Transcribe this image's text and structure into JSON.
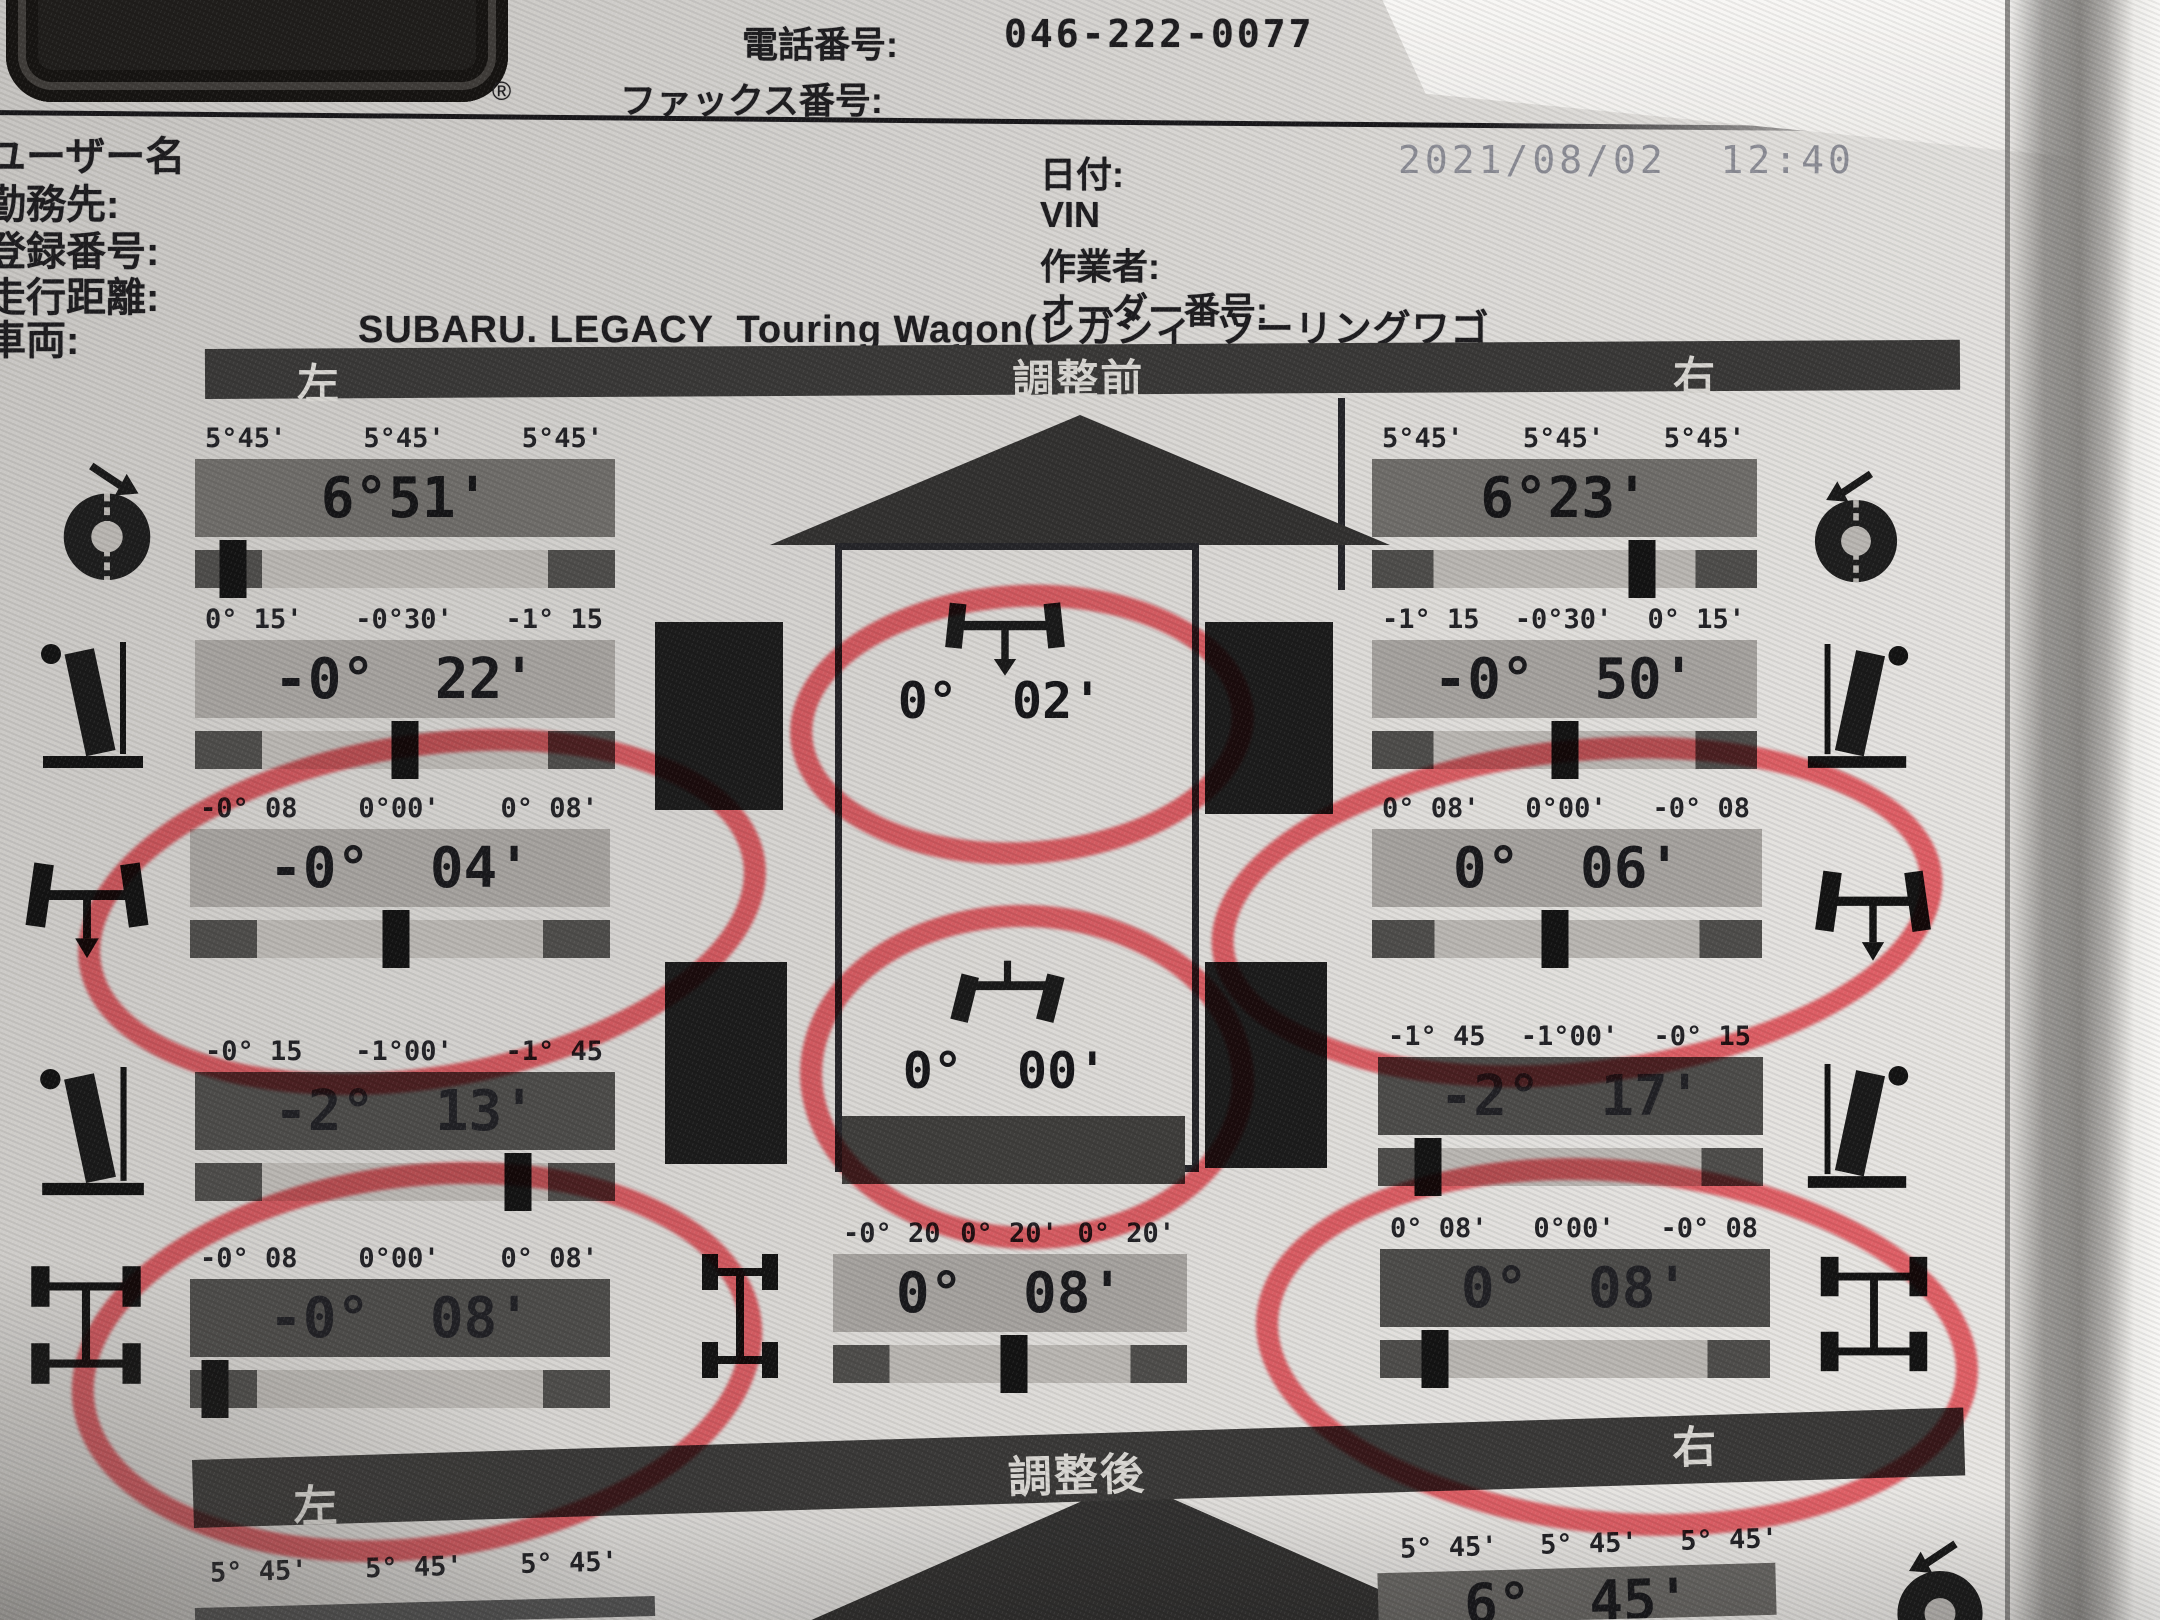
{
  "logo": {
    "text": "BEAN",
    "registered": "®"
  },
  "contact": {
    "phone_label": "電話番号:",
    "phone_value": "046-222-0077",
    "fax_label": "ファックス番号:"
  },
  "fields": {
    "user_label": "ユーザー名",
    "workplace_label": "勤務先:",
    "registration_label": "登録番号:",
    "mileage_label": "走行距離:",
    "vehicle_label": "車両:",
    "vehicle_value": "SUBARU. LEGACY  Touring Wagon(レガシィ  ツーリングワゴ",
    "date_label": "日付:",
    "date_value": "2021/08/02  12:40",
    "vin_label": "VIN",
    "operator_label": "作業者:",
    "order_label": "オーダー番号:"
  },
  "sections": {
    "before": {
      "left": "左",
      "title": "調整前",
      "right": "右"
    },
    "after": {
      "left": "左",
      "title": "調整後",
      "right": "右"
    }
  },
  "gauges": {
    "left_caster": {
      "ticks": [
        "5°45'",
        "5°45'",
        "5°45'"
      ],
      "value": "6°51'",
      "marker": 0.09,
      "circled": false
    },
    "left_front_camber": {
      "ticks": [
        "0° 15'",
        "-0°30'",
        "-1° 15"
      ],
      "value": "-0° 22'",
      "marker": 0.5,
      "circled": false
    },
    "left_front_toe": {
      "ticks": [
        "-0° 08",
        "0°00'",
        "0° 08'"
      ],
      "value": "-0° 04'",
      "marker": 0.49,
      "circled": true
    },
    "left_rear_camber": {
      "ticks": [
        "-0° 15",
        "-1°00'",
        "-1° 45"
      ],
      "value": "-2° 13'",
      "marker": 0.77,
      "circled": false
    },
    "left_rear_toe": {
      "ticks": [
        "-0° 08",
        "0°00'",
        "0° 08'"
      ],
      "value": "-0° 08'",
      "marker": 0.06,
      "circled": true
    },
    "front_total_toe": {
      "value": "0° 02'",
      "circled": true
    },
    "thrust_angle": {
      "value": "0° 00'",
      "circled": true
    },
    "rear_total_toe": {
      "ticks": [
        "-0° 20",
        "0° 20'",
        "0° 20'"
      ],
      "value": "0° 08'",
      "marker": 0.51,
      "circled": false
    },
    "right_caster": {
      "ticks": [
        "5°45'",
        "5°45'",
        "5°45'"
      ],
      "value": "6°23'",
      "marker": 0.7,
      "circled": false
    },
    "right_front_camber": {
      "ticks": [
        "-1° 15",
        "-0°30'",
        "0° 15'"
      ],
      "value": "-0° 50'",
      "marker": 0.5,
      "circled": false
    },
    "right_front_toe": {
      "ticks": [
        "0° 08'",
        "0°00'",
        "-0° 08"
      ],
      "value": "0° 06'",
      "marker": 0.47,
      "circled": true
    },
    "right_rear_camber": {
      "ticks": [
        "-1° 45",
        "-1°00'",
        "-0° 15"
      ],
      "value": "-2° 17'",
      "marker": 0.13,
      "circled": false
    },
    "right_rear_toe": {
      "ticks": [
        "0° 08'",
        "0°00'",
        "-0° 08"
      ],
      "value": "0° 08'",
      "marker": 0.14,
      "circled": true
    },
    "after_left_caster": {
      "ticks": [
        "5° 45'",
        "5° 45'",
        "5° 45'"
      ]
    },
    "after_right_caster": {
      "ticks": [
        "5° 45'",
        "5° 45'",
        "5° 45'"
      ],
      "value": "6° 45'"
    }
  }
}
